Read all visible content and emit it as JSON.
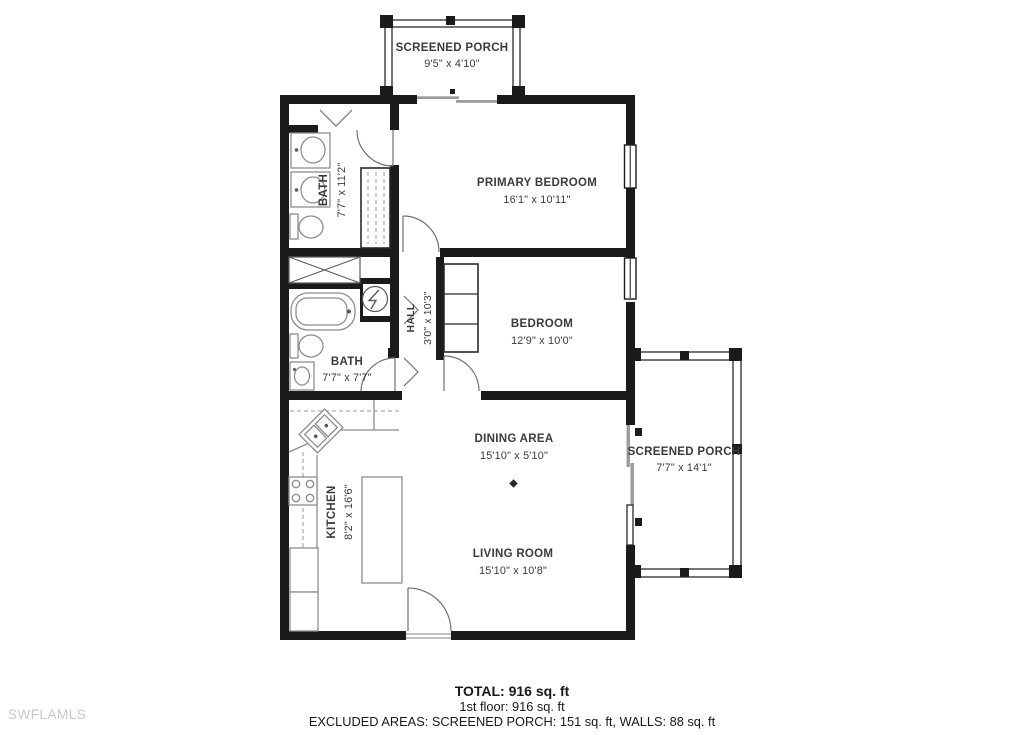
{
  "colors": {
    "walls": "#1b1b1b",
    "fixtures": "#8d8d8d",
    "label_text": "#3b3b3b",
    "watermark_text": "#c6c6c6",
    "background": "#ffffff"
  },
  "rooms": {
    "screened_porch_top": {
      "name": "SCREENED PORCH",
      "dims": "9'5\" x 4'10\""
    },
    "bath_upper": {
      "name": "BATH",
      "dims": "7'7\" x 11'2\""
    },
    "primary_bedroom": {
      "name": "PRIMARY BEDROOM",
      "dims": "16'1\" x 10'11\""
    },
    "hall": {
      "name": "HALL",
      "dims": "3'0\" x 10'3\""
    },
    "bedroom": {
      "name": "BEDROOM",
      "dims": "12'9\" x 10'0\""
    },
    "bath_lower": {
      "name": "BATH",
      "dims": "7'7\" x 7'7\""
    },
    "screened_porch_right": {
      "name": "SCREENED PORCH",
      "dims": "7'7\" x 14'1\""
    },
    "dining_area": {
      "name": "DINING AREA",
      "dims": "15'10\" x 5'10\""
    },
    "kitchen": {
      "name": "KITCHEN",
      "dims": "8'2\" x 16'6\""
    },
    "living_room": {
      "name": "LIVING ROOM",
      "dims": "15'10\" x 10'8\""
    }
  },
  "summary": {
    "total": "TOTAL: 916 sq. ft",
    "first_floor": "1st floor: 916 sq. ft",
    "excluded": "EXCLUDED AREAS: SCREENED PORCH: 151 sq. ft, WALLS: 88 sq. ft"
  },
  "watermark": "SWFLAMLS"
}
